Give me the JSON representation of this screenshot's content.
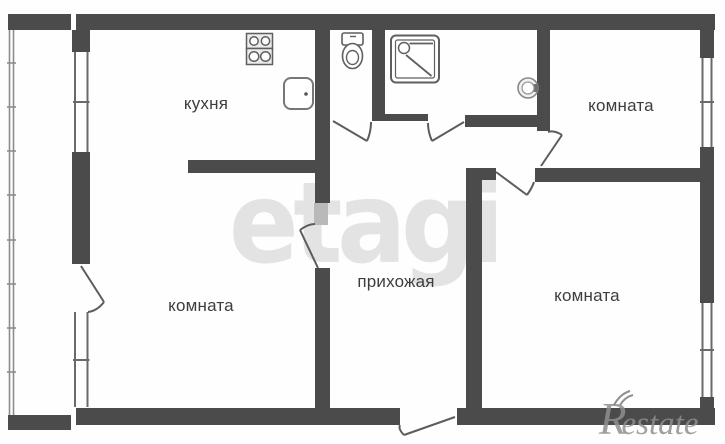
{
  "plan": {
    "type": "apartment-floor-plan",
    "rooms": {
      "kitchen": {
        "label": "кухня"
      },
      "room_top_right": {
        "label": "комната"
      },
      "room_bottom_left": {
        "label": "комната"
      },
      "room_bottom_right": {
        "label": "комната"
      },
      "hallway": {
        "label": "прихожая"
      }
    },
    "fixtures": [
      "stove-icon",
      "sink-icon",
      "toilet-icon",
      "shower-icon",
      "water-heater-icon"
    ],
    "features": [
      "balcony-glazing",
      "windows",
      "door-swings",
      "entrance-door"
    ]
  },
  "watermarks": {
    "center": "etagi",
    "logo_r": "R",
    "logo_rest": "estate"
  },
  "colors": {
    "wall": "#4b4b4b",
    "thin_line": "#5c5c5c",
    "door_panel": "#b9b9b9",
    "label_text": "#3d3d3d",
    "watermark_center": "#e3e3e3",
    "watermark_logo": "#8f8f8f",
    "background": "#fefefe"
  }
}
